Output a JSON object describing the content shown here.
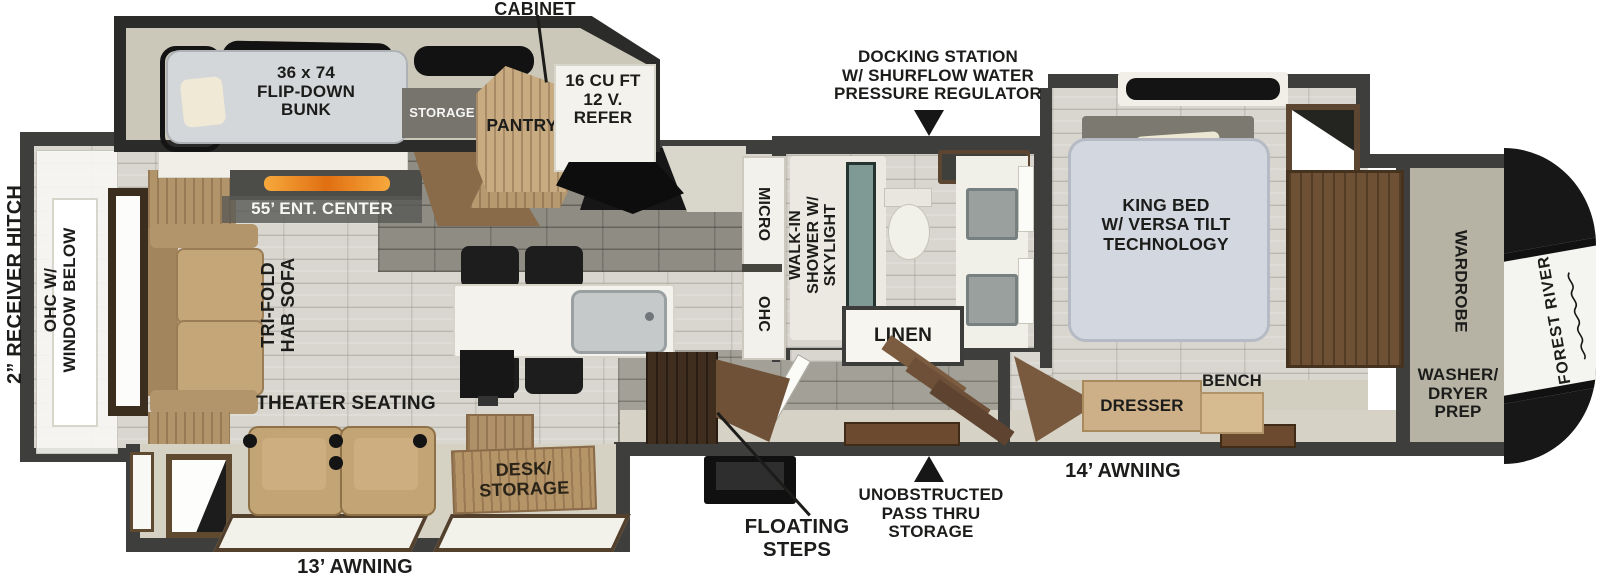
{
  "floorplan": {
    "brand": "FOREST RIVER",
    "exterior": {
      "cabinet": "CABINET",
      "docking_lines": [
        "DOCKING STATION",
        "W/ SHURFLOW WATER",
        "PRESSURE REGULATOR"
      ],
      "receiver_hitch": "2” RECEIVER HITCH",
      "floating_lines": [
        "FLOATING",
        "STEPS"
      ],
      "passthru_lines": [
        "UNOBSTRUCTED",
        "PASS THRU",
        "STORAGE"
      ],
      "awning_14": "14’ AWNING",
      "awning_13": "13’ AWNING"
    },
    "rooms": {
      "bunk_lines": [
        "36 x 74",
        "FLIP-DOWN",
        "BUNK"
      ],
      "storage": "STORAGE",
      "pantry": "PANTRY",
      "refer_lines": [
        "16 CU FT",
        "12 V.",
        "REFER"
      ],
      "ohc_window_lines": [
        "OHC W/",
        "WINDOW BELOW"
      ],
      "ent_center": "55’ ENT. CENTER",
      "sofa_lines": [
        "TRI-FOLD",
        "HAB SOFA"
      ],
      "micro": "MICRO",
      "ohc": "OHC",
      "shower_lines": [
        "WALK-IN",
        "SHOWER W/",
        "SKYLIGHT"
      ],
      "linen": "LINEN",
      "king_bed_lines": [
        "KING BED",
        "W/ VERSA TILT",
        "TECHNOLOGY"
      ],
      "wardrobe": "WARDROBE",
      "washer_lines": [
        "WASHER/",
        "DRYER",
        "PREP"
      ],
      "theater": "THEATER SEATING",
      "desk_lines": [
        "DESK/",
        "STORAGE"
      ],
      "dresser": "DRESSER",
      "bench": "BENCH"
    },
    "colors": {
      "wall": "#3e3e3c",
      "accent_blue": "#2566ab",
      "flame_orange": "#e8791c",
      "wood": "#b59468",
      "label_text": "#1c1c1a",
      "cap_black": "#171717"
    }
  }
}
